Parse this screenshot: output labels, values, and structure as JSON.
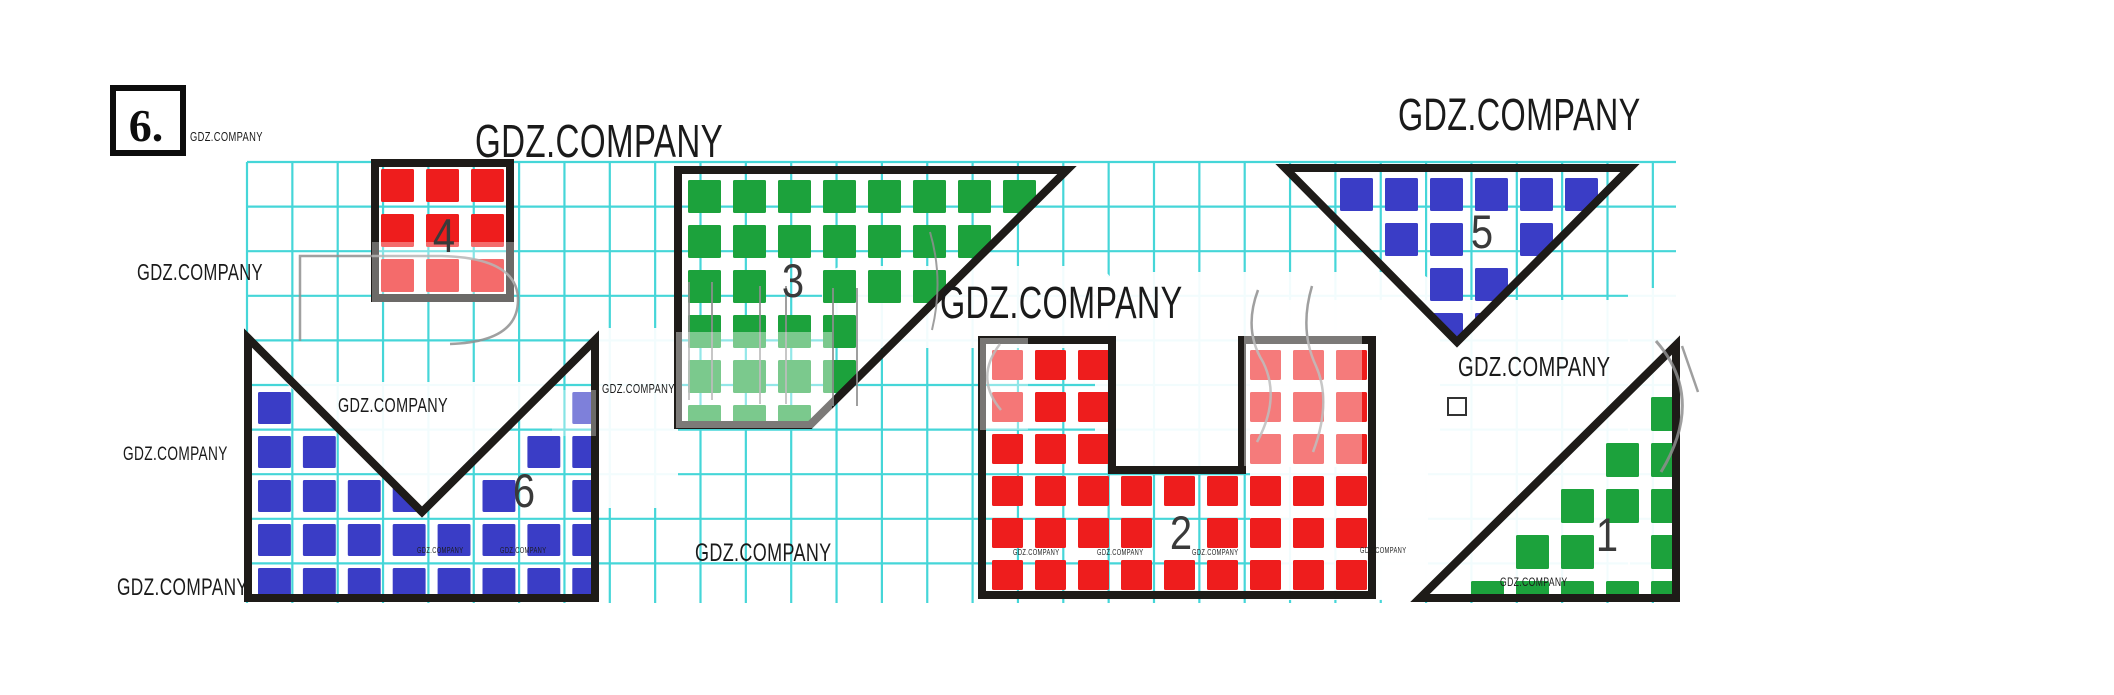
{
  "exercise_number": "6.",
  "watermark_text": "GDZ.COMPANY",
  "colors": {
    "grid": "#3cd4d6",
    "outline": "#1e1b18",
    "red": "#ee1d1d",
    "green": "#1ca23c",
    "blue": "#3a3dc6",
    "label": "#3a3a3a",
    "watermark": "#1a1a1a",
    "wash": "#ffffff",
    "stroke_fragment": "#8f8f8f"
  },
  "grid": {
    "x0": 247,
    "y0": 162,
    "x1": 1676,
    "y1": 603,
    "cell_w": 45.35,
    "cell_h": 44.6
  },
  "exercise_box": {
    "x": 113,
    "y": 88,
    "w": 70,
    "h": 65
  },
  "small_square_icon": {
    "x": 1448,
    "y": 398,
    "w": 18,
    "h": 17
  },
  "figures": [
    {
      "label": "1",
      "color": "green",
      "polygon": [
        [
          1420,
          598
        ],
        [
          1676,
          345
        ],
        [
          1676,
          598
        ]
      ],
      "origin": [
        1420,
        345
      ],
      "cw": 45,
      "ch": 46,
      "cells": [
        [
          5,
          1
        ],
        [
          4,
          2
        ],
        [
          5,
          2
        ],
        [
          3,
          3
        ],
        [
          4,
          3
        ],
        [
          5,
          3
        ],
        [
          2,
          4
        ],
        [
          3,
          4
        ],
        [
          5,
          4
        ],
        [
          1,
          5
        ],
        [
          2,
          5
        ],
        [
          3,
          5
        ],
        [
          4,
          5
        ],
        [
          5,
          5
        ]
      ],
      "label_pos": [
        1607,
        551
      ]
    },
    {
      "label": "2",
      "color": "red",
      "polygon": [
        [
          982,
          340
        ],
        [
          1112,
          340
        ],
        [
          1112,
          470
        ],
        [
          1242,
          470
        ],
        [
          1242,
          340
        ],
        [
          1372,
          340
        ],
        [
          1372,
          595
        ],
        [
          982,
          595
        ]
      ],
      "origin": [
        986,
        344
      ],
      "cw": 43,
      "ch": 42,
      "cells": [
        [
          0,
          0
        ],
        [
          1,
          0
        ],
        [
          2,
          0
        ],
        [
          6,
          0
        ],
        [
          7,
          0
        ],
        [
          8,
          0
        ],
        [
          0,
          1
        ],
        [
          1,
          1
        ],
        [
          2,
          1
        ],
        [
          6,
          1
        ],
        [
          7,
          1
        ],
        [
          8,
          1
        ],
        [
          0,
          2
        ],
        [
          1,
          2
        ],
        [
          2,
          2
        ],
        [
          6,
          2
        ],
        [
          7,
          2
        ],
        [
          8,
          2
        ],
        [
          0,
          3
        ],
        [
          1,
          3
        ],
        [
          2,
          3
        ],
        [
          3,
          3
        ],
        [
          4,
          3
        ],
        [
          5,
          3
        ],
        [
          6,
          3
        ],
        [
          7,
          3
        ],
        [
          8,
          3
        ],
        [
          0,
          4
        ],
        [
          1,
          4
        ],
        [
          2,
          4
        ],
        [
          3,
          4
        ],
        [
          5,
          4
        ],
        [
          6,
          4
        ],
        [
          7,
          4
        ],
        [
          8,
          4
        ],
        [
          0,
          5
        ],
        [
          1,
          5
        ],
        [
          2,
          5
        ],
        [
          3,
          5
        ],
        [
          4,
          5
        ],
        [
          5,
          5
        ],
        [
          6,
          5
        ],
        [
          7,
          5
        ],
        [
          8,
          5
        ]
      ],
      "label_pos": [
        1181,
        549
      ]
    },
    {
      "label": "3",
      "color": "green",
      "polygon": [
        [
          678,
          170
        ],
        [
          1067,
          170
        ],
        [
          810,
          425
        ],
        [
          678,
          425
        ]
      ],
      "origin": [
        682,
        174
      ],
      "cw": 45,
      "ch": 45,
      "cells": [
        [
          0,
          0
        ],
        [
          1,
          0
        ],
        [
          2,
          0
        ],
        [
          3,
          0
        ],
        [
          4,
          0
        ],
        [
          5,
          0
        ],
        [
          6,
          0
        ],
        [
          7,
          0
        ],
        [
          0,
          1
        ],
        [
          1,
          1
        ],
        [
          2,
          1
        ],
        [
          3,
          1
        ],
        [
          4,
          1
        ],
        [
          5,
          1
        ],
        [
          6,
          1
        ],
        [
          0,
          2
        ],
        [
          1,
          2
        ],
        [
          3,
          2
        ],
        [
          4,
          2
        ],
        [
          5,
          2
        ],
        [
          0,
          3
        ],
        [
          1,
          3
        ],
        [
          2,
          3
        ],
        [
          3,
          3
        ],
        [
          0,
          4
        ],
        [
          1,
          4
        ],
        [
          2,
          4
        ],
        [
          3,
          4
        ],
        [
          0,
          5
        ],
        [
          1,
          5
        ],
        [
          2,
          5
        ]
      ],
      "label_pos": [
        793,
        297
      ]
    },
    {
      "label": "4",
      "color": "red",
      "polygon": [
        [
          375,
          163
        ],
        [
          510,
          163
        ],
        [
          510,
          298
        ],
        [
          375,
          298
        ]
      ],
      "origin": [
        375,
        163
      ],
      "cw": 45,
      "ch": 45,
      "cells": [
        [
          0,
          0
        ],
        [
          1,
          0
        ],
        [
          2,
          0
        ],
        [
          0,
          1
        ],
        [
          1,
          1
        ],
        [
          2,
          1
        ],
        [
          0,
          2
        ],
        [
          1,
          2
        ],
        [
          2,
          2
        ]
      ],
      "label_pos": [
        444,
        252
      ]
    },
    {
      "label": "5",
      "color": "blue",
      "polygon": [
        [
          1285,
          168
        ],
        [
          1630,
          168
        ],
        [
          1457,
          342
        ]
      ],
      "origin": [
        1289,
        172
      ],
      "cw": 45,
      "ch": 45,
      "cells": [
        [
          1,
          0
        ],
        [
          2,
          0
        ],
        [
          3,
          0
        ],
        [
          4,
          0
        ],
        [
          5,
          0
        ],
        [
          6,
          0
        ],
        [
          2,
          1
        ],
        [
          3,
          1
        ],
        [
          5,
          1
        ],
        [
          3,
          2
        ],
        [
          4,
          2
        ],
        [
          3,
          3
        ],
        [
          4,
          3
        ]
      ],
      "label_pos": [
        1482,
        248
      ]
    },
    {
      "label": "6",
      "color": "blue",
      "polygon": [
        [
          248,
          338
        ],
        [
          422,
          512
        ],
        [
          595,
          340
        ],
        [
          595,
          598
        ],
        [
          248,
          598
        ]
      ],
      "origin": [
        252,
        342
      ],
      "cw": 44.9,
      "ch": 44,
      "cells": [
        [
          0,
          1
        ],
        [
          7,
          1
        ],
        [
          0,
          2
        ],
        [
          1,
          2
        ],
        [
          6,
          2
        ],
        [
          7,
          2
        ],
        [
          0,
          3
        ],
        [
          1,
          3
        ],
        [
          2,
          3
        ],
        [
          3,
          3
        ],
        [
          5,
          3
        ],
        [
          7,
          3
        ],
        [
          0,
          4
        ],
        [
          1,
          4
        ],
        [
          2,
          4
        ],
        [
          3,
          4
        ],
        [
          4,
          4
        ],
        [
          5,
          4
        ],
        [
          6,
          4
        ],
        [
          7,
          4
        ],
        [
          0,
          5
        ],
        [
          1,
          5
        ],
        [
          2,
          5
        ],
        [
          3,
          5
        ],
        [
          4,
          5
        ],
        [
          5,
          5
        ],
        [
          6,
          5
        ],
        [
          7,
          5
        ]
      ],
      "label_pos": [
        524,
        507
      ]
    }
  ],
  "watermarks": [
    {
      "x": 190,
      "y": 141,
      "s": 13
    },
    {
      "x": 475,
      "y": 157,
      "s": 46
    },
    {
      "x": 1398,
      "y": 130,
      "s": 45
    },
    {
      "x": 137,
      "y": 280,
      "s": 23
    },
    {
      "x": 940,
      "y": 318,
      "s": 45
    },
    {
      "x": 123,
      "y": 460,
      "s": 19
    },
    {
      "x": 117,
      "y": 595,
      "s": 24
    },
    {
      "x": 338,
      "y": 412,
      "s": 20
    },
    {
      "x": 602,
      "y": 393,
      "s": 13
    },
    {
      "x": 417,
      "y": 553,
      "s": 8
    },
    {
      "x": 500,
      "y": 553,
      "s": 8
    },
    {
      "x": 695,
      "y": 561,
      "s": 25
    },
    {
      "x": 1013,
      "y": 555,
      "s": 8
    },
    {
      "x": 1097,
      "y": 555,
      "s": 8
    },
    {
      "x": 1192,
      "y": 555,
      "s": 8
    },
    {
      "x": 1360,
      "y": 553,
      "s": 8
    },
    {
      "x": 1458,
      "y": 376,
      "s": 28
    },
    {
      "x": 1500,
      "y": 586,
      "s": 12
    }
  ],
  "wash_under": [
    {
      "type": "poly",
      "pts": [
        [
          285,
          382
        ],
        [
          558,
          382
        ],
        [
          424,
          514
        ]
      ]
    },
    {
      "type": "rect",
      "x": 598,
      "y": 328,
      "w": 80,
      "h": 180,
      "r": 10
    },
    {
      "type": "rect",
      "x": 822,
      "y": 266,
      "w": 292,
      "h": 82,
      "r": 24
    },
    {
      "type": "rect",
      "x": 1095,
      "y": 272,
      "w": 345,
      "h": 195,
      "r": 30
    },
    {
      "type": "rect",
      "x": 1250,
      "y": 300,
      "w": 380,
      "h": 300,
      "r": 0
    },
    {
      "type": "rect",
      "x": 1628,
      "y": 288,
      "w": 56,
      "h": 312,
      "r": 0
    },
    {
      "type": "rect",
      "x": 1370,
      "y": 335,
      "w": 58,
      "h": 264,
      "r": 0
    }
  ],
  "wash_over": [
    {
      "x": 372,
      "y": 242,
      "w": 142,
      "h": 60,
      "o": 0.35
    },
    {
      "x": 676,
      "y": 332,
      "w": 156,
      "h": 96,
      "o": 0.42
    },
    {
      "x": 980,
      "y": 338,
      "w": 48,
      "h": 92,
      "o": 0.4
    },
    {
      "x": 1244,
      "y": 336,
      "w": 118,
      "h": 130,
      "o": 0.42
    },
    {
      "x": 552,
      "y": 390,
      "w": 44,
      "h": 46,
      "o": 0.35
    }
  ],
  "stroke_fragments": [
    {
      "d": "M300,341 L300,256 L442,256 Q518,258 518,300 Q518,342 450,344",
      "w": 2.5
    },
    {
      "d": "M689,282 L689,400",
      "w": 2
    },
    {
      "d": "M712,282 L712,400",
      "w": 2
    },
    {
      "d": "M760,286 L760,404",
      "w": 2
    },
    {
      "d": "M786,286 L786,404",
      "w": 2
    },
    {
      "d": "M833,288 L833,406",
      "w": 2
    },
    {
      "d": "M857,288 L857,406",
      "w": 2
    },
    {
      "d": "M1000,344 Q974,378 1001,410",
      "w": 2.5
    },
    {
      "d": "M1258,290 Q1243,330 1263,362 Q1281,398 1257,442",
      "w": 2.5
    },
    {
      "d": "M1312,286 Q1299,330 1316,366 Q1332,402 1313,452",
      "w": 2.5
    },
    {
      "d": "M1656,341 Q1706,398 1661,472",
      "w": 3
    },
    {
      "d": "M1682,346 L1698,392",
      "w": 2.5
    },
    {
      "d": "M930,232 Q944,280 932,330",
      "w": 2
    }
  ]
}
